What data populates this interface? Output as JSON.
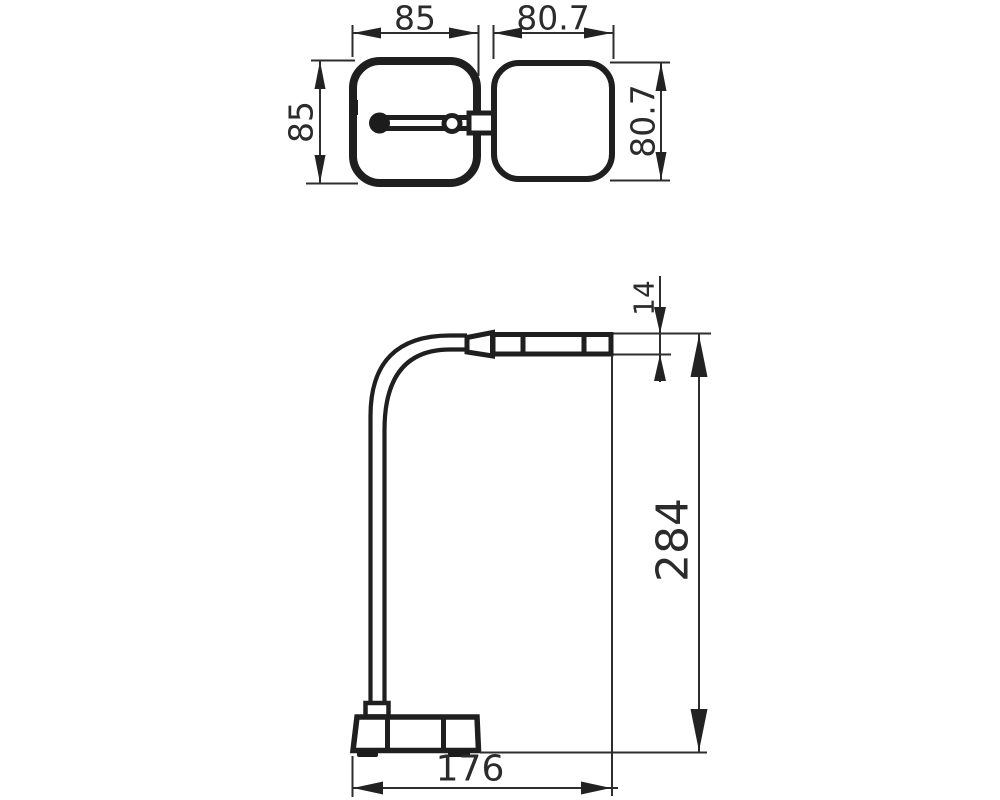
{
  "drawing": {
    "top_view": {
      "base_width_label": "85",
      "base_depth_label": "85",
      "head_width_label": "80.7",
      "head_depth_label": "80.7"
    },
    "side_view": {
      "head_thickness_label": "14",
      "overall_height_label": "284",
      "overall_depth_label": "176"
    }
  }
}
